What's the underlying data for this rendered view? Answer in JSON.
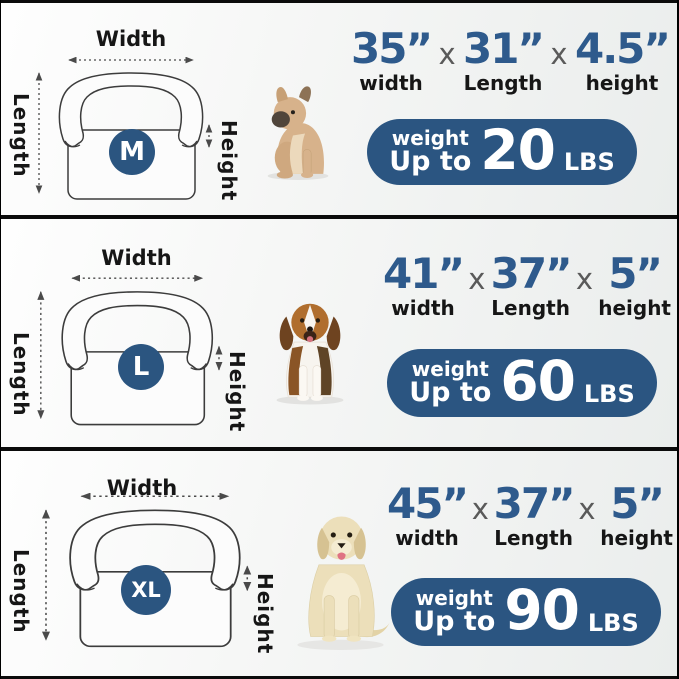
{
  "colors": {
    "dimension_blue": "#2e5a8c",
    "weight_pill_blue": "#2b5581",
    "size_badge_blue": "#2b5580",
    "label_black": "#161616",
    "divider_black": "#0b0b0b"
  },
  "sections": [
    {
      "size_badge": "M",
      "dog": "french-bulldog-puppy-photo",
      "diagram": {
        "width_label": "Width",
        "length_label": "Length",
        "height_label": "Height"
      },
      "sep": "x",
      "dims": [
        {
          "value": "35”",
          "label": "width"
        },
        {
          "value": "31”",
          "label": "Length"
        },
        {
          "value": "4.5”",
          "label": "height"
        }
      ],
      "weight": {
        "word": "weight",
        "upto": "Up to",
        "number": "20",
        "unit": "LBS"
      }
    },
    {
      "size_badge": "L",
      "dog": "beagle-photo",
      "diagram": {
        "width_label": "Width",
        "length_label": "Length",
        "height_label": "Height"
      },
      "sep": "x",
      "dims": [
        {
          "value": "41”",
          "label": "width"
        },
        {
          "value": "37”",
          "label": "Length"
        },
        {
          "value": "5”",
          "label": "height"
        }
      ],
      "weight": {
        "word": "weight",
        "upto": "Up to",
        "number": "60",
        "unit": "LBS"
      }
    },
    {
      "size_badge": "XL",
      "dog": "labrador-photo",
      "diagram": {
        "width_label": "Width",
        "length_label": "Length",
        "height_label": "Height"
      },
      "sep": "x",
      "dims": [
        {
          "value": "45”",
          "label": "width"
        },
        {
          "value": "37”",
          "label": "Length"
        },
        {
          "value": "5”",
          "label": "height"
        }
      ],
      "weight": {
        "word": "weight",
        "upto": "Up to",
        "number": "90",
        "unit": "LBS"
      }
    }
  ]
}
